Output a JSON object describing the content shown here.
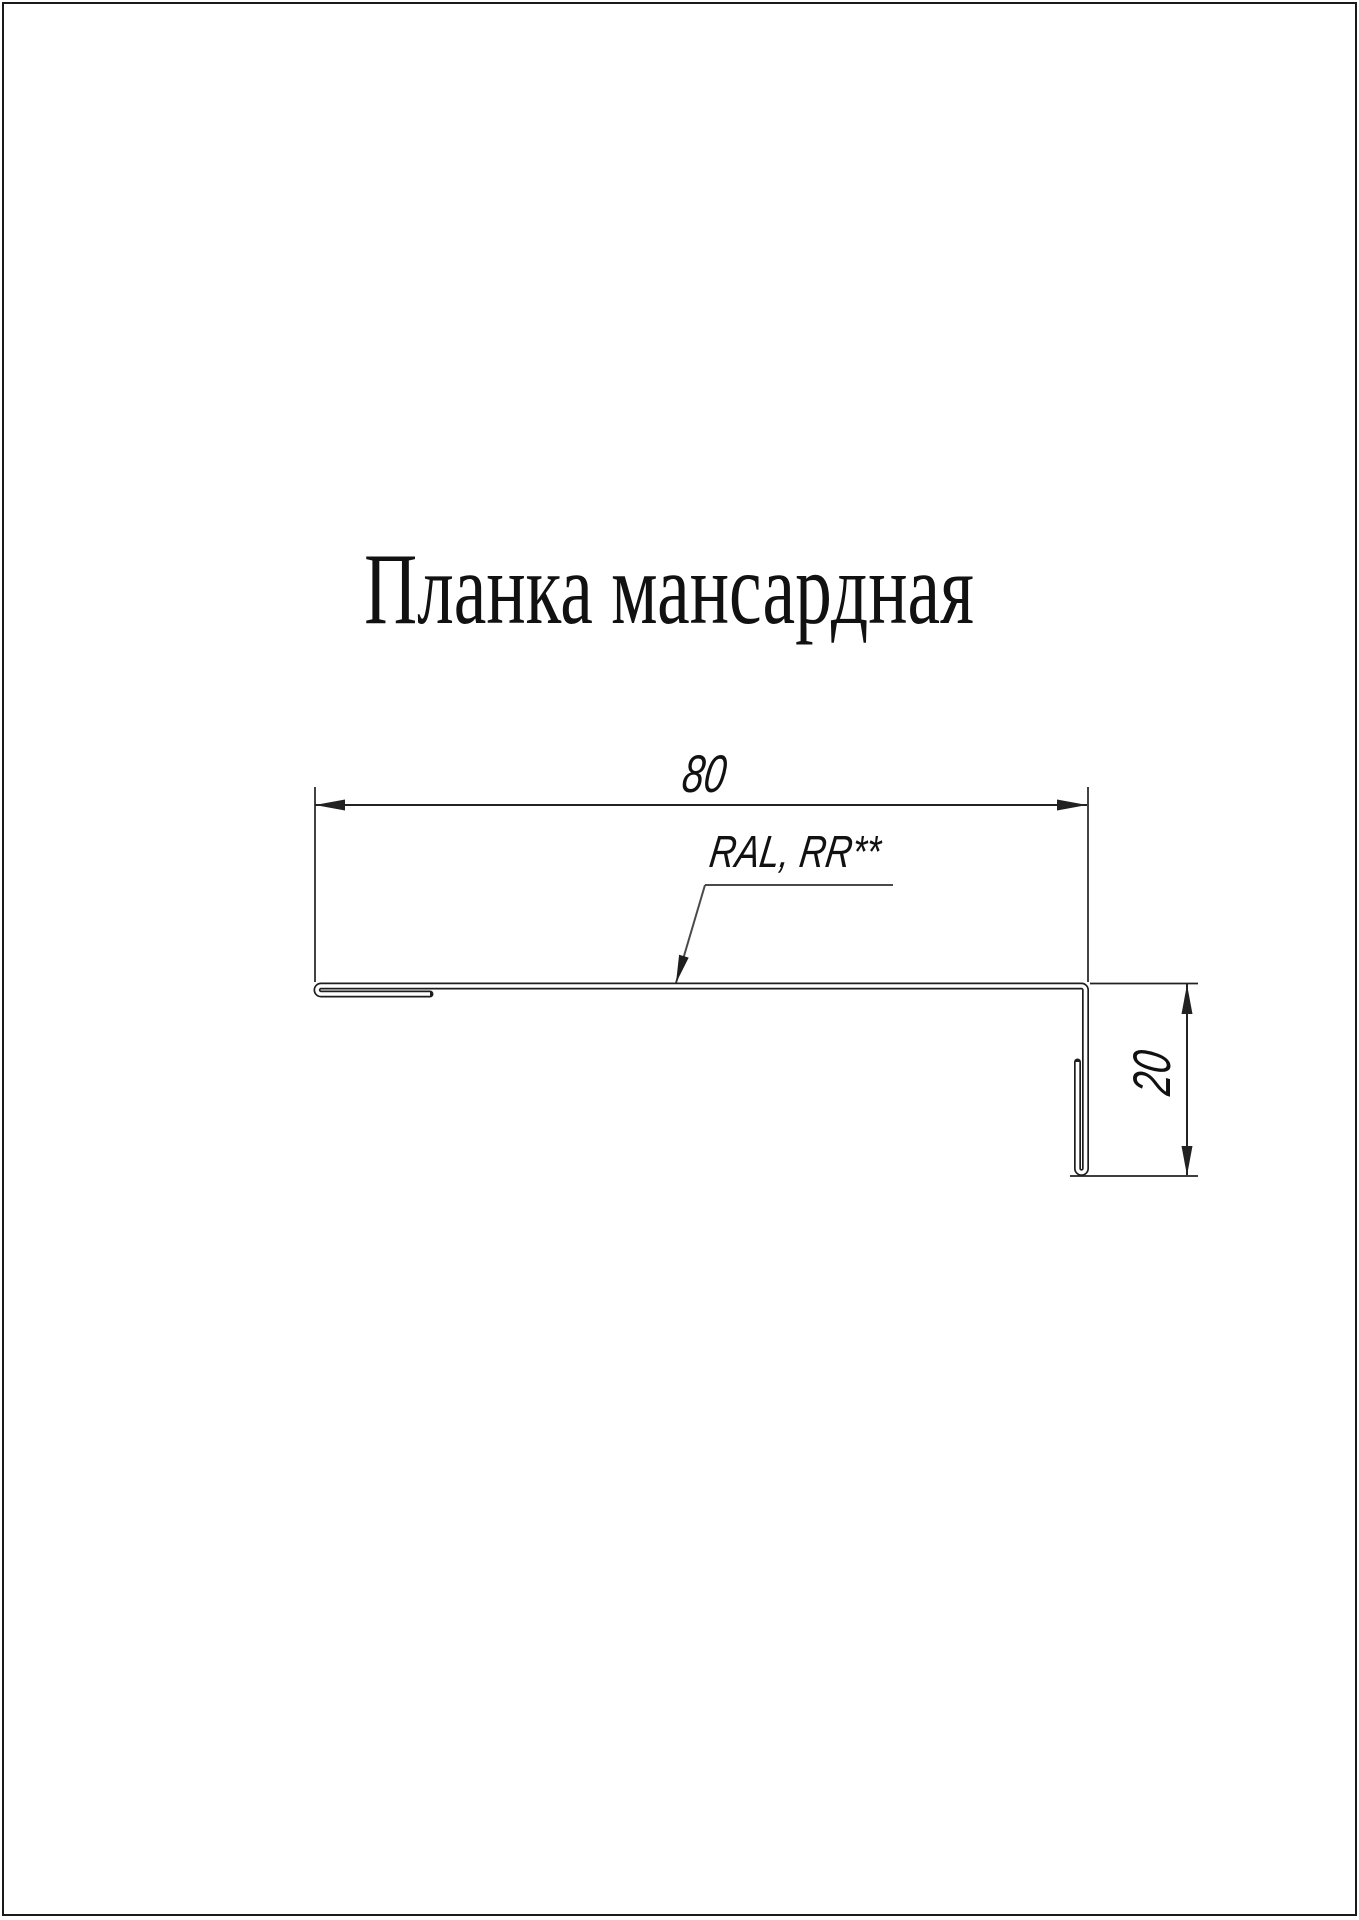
{
  "page": {
    "width": 1359,
    "height": 1920,
    "background": "#ffffff"
  },
  "title": {
    "text": "Планка мансардная"
  },
  "drawing": {
    "part": "mansard-strip-cross-section",
    "dimension_width": {
      "value": "80",
      "orientation": "horizontal"
    },
    "dimension_height": {
      "value": "20",
      "orientation": "vertical"
    },
    "coating_label": {
      "text": "RAL, RR**"
    },
    "colors": {
      "line": "#222222",
      "profile": "#1e1e1e",
      "leader": "#4a4a4a",
      "border": "#1a1a1a",
      "text": "#111111",
      "background": "#ffffff"
    }
  }
}
